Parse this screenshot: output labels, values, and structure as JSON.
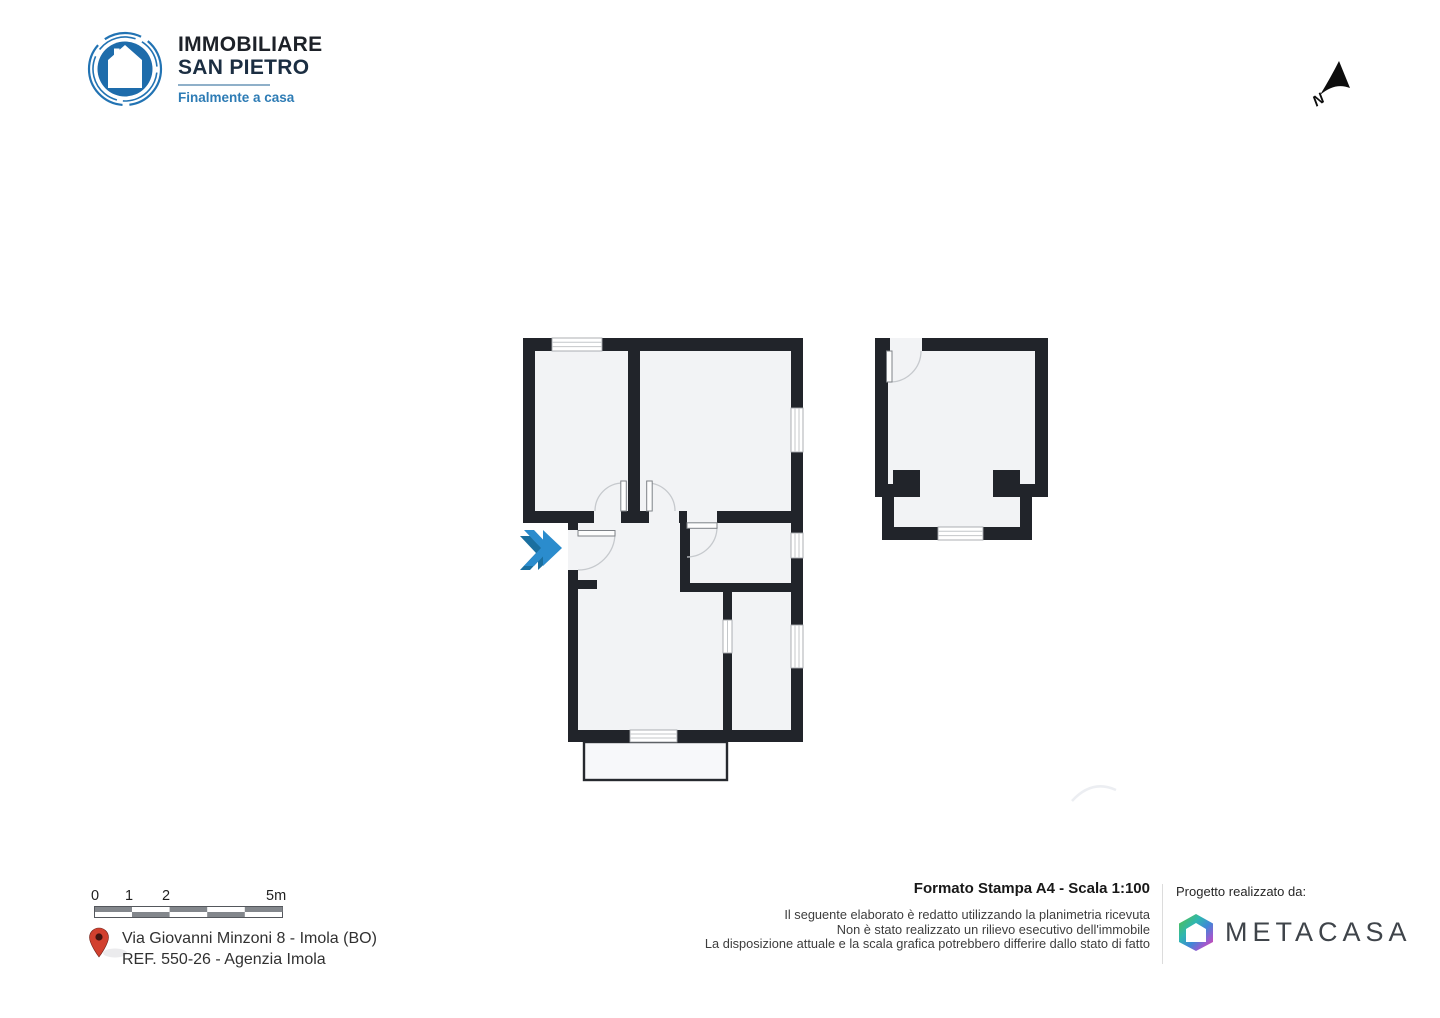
{
  "agency_logo": {
    "name_line1": "IMMOBILIARE",
    "name_line2": "SAN PIETRO",
    "tagline": "Finalmente a casa"
  },
  "north_indicator": {
    "label": "N"
  },
  "scale_bar": {
    "labels": {
      "l0": "0",
      "l1": "1",
      "l2": "2",
      "l5": "5m"
    }
  },
  "address": {
    "line1": "Via Giovanni Minzoni 8 - Imola (BO)",
    "line2": "REF. 550-26 - Agenzia Imola"
  },
  "print_info": {
    "title": "Formato Stampa A4 - Scala 1:100",
    "disclaimers": [
      "Il seguente elaborato è redatto utilizzando la planimetria ricevuta",
      "Non è stato realizzato un rilievo esecutivo dell'immobile",
      "La disposizione attuale e la scala grafica potrebbero differire dallo stato di fatto"
    ]
  },
  "credits": {
    "label": "Progetto realizzato da:",
    "brand": "METACASA"
  },
  "colors": {
    "wall": "#21242a",
    "room_fill": "#f2f3f5",
    "entrance_marker_blue": "#2b8ccd",
    "entrance_marker_shadow": "#1a6f9f",
    "logo_blue": "#1e6cab",
    "tagline_blue": "#2e7cb5",
    "pin_red": "#d2402e"
  }
}
